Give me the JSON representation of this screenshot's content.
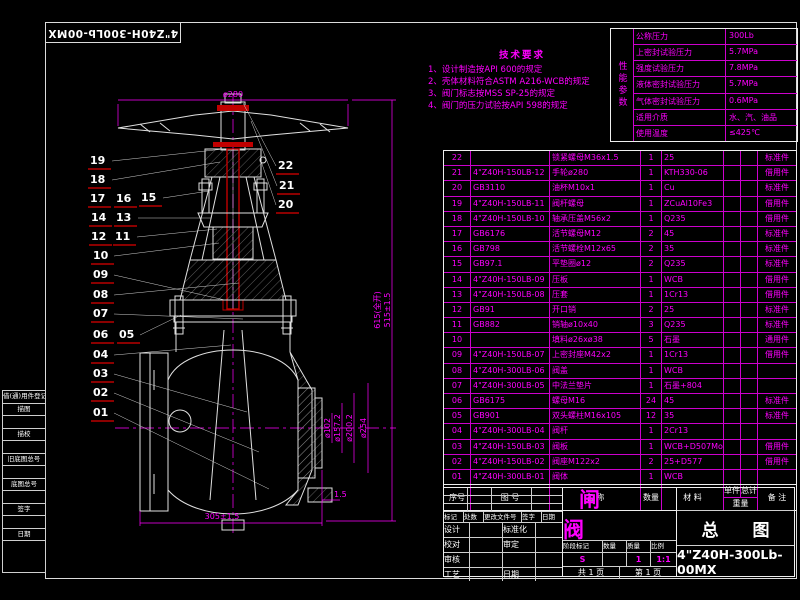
{
  "sheet": {
    "corner_stamp": "4\"Z40H-300Lb-00MX"
  },
  "tech_requirements": {
    "title": "技术要求",
    "items": [
      "1、设计制造按API 600的规定",
      "2、壳体材料符合ASTM A216-WCB的规定",
      "3、阀门标志按MSS SP-25的规定",
      "4、阀门的压力试验按API 598的规定"
    ]
  },
  "performance_table": {
    "caption": "性能参数",
    "rows": [
      {
        "label": "公称压力",
        "value": "300Lb"
      },
      {
        "label": "上密封试验压力",
        "value": "5.7MPa"
      },
      {
        "label": "强度试验压力",
        "value": "7.8MPa"
      },
      {
        "label": "液体密封试验压力",
        "value": "5.7MPa"
      },
      {
        "label": "气体密封试验压力",
        "value": "0.6MPa"
      },
      {
        "label": "适用介质",
        "value": "水、汽、油品"
      },
      {
        "label": "使用温度",
        "value": "≤425℃"
      }
    ]
  },
  "parts_table": {
    "headers": {
      "seq": "序号",
      "dwg_no": "图    号",
      "name": "名    称",
      "qty": "数量",
      "material": "材    料",
      "unit": "单件",
      "total": "总计",
      "weight": "重量",
      "remark": "备  注"
    },
    "rows": [
      {
        "seq": "22",
        "dwg_no": "",
        "name": "锁紧螺母M36x1.5",
        "qty": "1",
        "material": "25",
        "remark": "标准件"
      },
      {
        "seq": "21",
        "dwg_no": "4\"Z40H-150LB-12",
        "name": "手轮ø280",
        "qty": "1",
        "material": "KTH330-06",
        "remark": "借用件"
      },
      {
        "seq": "20",
        "dwg_no": "GB3110",
        "name": "油杯M10x1",
        "qty": "1",
        "material": "Cu",
        "remark": "标准件"
      },
      {
        "seq": "19",
        "dwg_no": "4\"Z40H-150LB-11",
        "name": "阀杆螺母",
        "qty": "1",
        "material": "ZCuAl10Fe3",
        "remark": "借用件"
      },
      {
        "seq": "18",
        "dwg_no": "4\"Z40H-150LB-10",
        "name": "轴承压盖M56x2",
        "qty": "1",
        "material": "Q235",
        "remark": "借用件"
      },
      {
        "seq": "17",
        "dwg_no": "GB6176",
        "name": "活节螺母M12",
        "qty": "2",
        "material": "45",
        "remark": "标准件"
      },
      {
        "seq": "16",
        "dwg_no": "GB798",
        "name": "活节螺栓M12x65",
        "qty": "2",
        "material": "35",
        "remark": "标准件"
      },
      {
        "seq": "15",
        "dwg_no": "GB97.1",
        "name": "平垫圈ø12",
        "qty": "2",
        "material": "Q235",
        "remark": "标准件"
      },
      {
        "seq": "14",
        "dwg_no": "4\"Z40H-150LB-09",
        "name": "压板",
        "qty": "1",
        "material": "WCB",
        "remark": "借用件"
      },
      {
        "seq": "13",
        "dwg_no": "4\"Z40H-150LB-08",
        "name": "压套",
        "qty": "1",
        "material": "1Cr13",
        "remark": "借用件"
      },
      {
        "seq": "12",
        "dwg_no": "GB91",
        "name": "开口销",
        "qty": "2",
        "material": "25",
        "remark": "标准件"
      },
      {
        "seq": "11",
        "dwg_no": "GB882",
        "name": "销轴ø10x40",
        "qty": "3",
        "material": "Q235",
        "remark": "标准件"
      },
      {
        "seq": "10",
        "dwg_no": "",
        "name": "填料ø26xø38",
        "qty": "5",
        "material": "石墨",
        "remark": "通用件"
      },
      {
        "seq": "09",
        "dwg_no": "4\"Z40H-150LB-07",
        "name": "上密封座M42x2",
        "qty": "1",
        "material": "1Cr13",
        "remark": "借用件"
      },
      {
        "seq": "08",
        "dwg_no": "4\"Z40H-300LB-06",
        "name": "阀盖",
        "qty": "1",
        "material": "WCB",
        "remark": ""
      },
      {
        "seq": "07",
        "dwg_no": "4\"Z40H-300LB-05",
        "name": "中法兰垫片",
        "qty": "1",
        "material": "石墨+804",
        "remark": ""
      },
      {
        "seq": "06",
        "dwg_no": "GB6175",
        "name": "螺母M16",
        "qty": "24",
        "material": "45",
        "remark": "标准件"
      },
      {
        "seq": "05",
        "dwg_no": "GB901",
        "name": "双头螺柱M16x105",
        "qty": "12",
        "material": "35",
        "remark": "标准件"
      },
      {
        "seq": "04",
        "dwg_no": "4\"Z40H-300LB-04",
        "name": "阀杆",
        "qty": "1",
        "material": "2Cr13",
        "remark": ""
      },
      {
        "seq": "03",
        "dwg_no": "4\"Z40H-150LB-03",
        "name": "阀板",
        "qty": "1",
        "material": "WCB+D507Mo",
        "remark": "借用件"
      },
      {
        "seq": "02",
        "dwg_no": "4\"Z40H-150LB-02",
        "name": "阀座M122x2",
        "qty": "2",
        "material": "25+D577",
        "remark": "借用件"
      },
      {
        "seq": "01",
        "dwg_no": "4\"Z40H-300LB-01",
        "name": "阀体",
        "qty": "1",
        "material": "WCB",
        "remark": ""
      }
    ]
  },
  "title_block": {
    "product_title": "闸  阀",
    "sheet_title": "总  图",
    "drawing_no": "4\"Z40H-300Lb-00MX",
    "rev_header": [
      "标记",
      "处数",
      "更改文件号",
      "签字",
      "日期"
    ],
    "roles": [
      {
        "left": "设计",
        "right": "标准化"
      },
      {
        "left": "校对",
        "right": "审定"
      },
      {
        "left": "审核",
        "right": ""
      },
      {
        "left": "工艺",
        "right": "日期"
      }
    ],
    "stage_header": [
      "阶段标记",
      "数量",
      "质量",
      "比例"
    ],
    "stage_values": [
      "S",
      "",
      "1",
      "1:1"
    ],
    "pages_total": "共 1 页",
    "pages_current": "第 1 页"
  },
  "margin_strip": {
    "rows": [
      "借(通)用件登记",
      "描图",
      "",
      "描校",
      "",
      "旧底图总号",
      "",
      "底图总号",
      "",
      "签字",
      "",
      "日期"
    ]
  },
  "dimensions": {
    "handwheel_dia": "ø280",
    "face_to_face": "305±1.5",
    "raised_face": "1.5",
    "flange": [
      "ø102",
      "ø157.2",
      "ø200.2",
      "ø254"
    ],
    "height_closed": "515±1.5",
    "height_open": "615(全开)"
  },
  "balloons": [
    {
      "n": "19",
      "x": 88,
      "y": 155
    },
    {
      "n": "18",
      "x": 88,
      "y": 174
    },
    {
      "n": "17",
      "x": 88,
      "y": 193
    },
    {
      "n": "16",
      "x": 114,
      "y": 193
    },
    {
      "n": "15",
      "x": 139,
      "y": 192
    },
    {
      "n": "14",
      "x": 89,
      "y": 212
    },
    {
      "n": "13",
      "x": 114,
      "y": 212
    },
    {
      "n": "12",
      "x": 89,
      "y": 231
    },
    {
      "n": "11",
      "x": 113,
      "y": 231
    },
    {
      "n": "10",
      "x": 91,
      "y": 250
    },
    {
      "n": "09",
      "x": 91,
      "y": 269
    },
    {
      "n": "08",
      "x": 91,
      "y": 289
    },
    {
      "n": "07",
      "x": 91,
      "y": 308
    },
    {
      "n": "06",
      "x": 91,
      "y": 329
    },
    {
      "n": "05",
      "x": 117,
      "y": 329
    },
    {
      "n": "04",
      "x": 91,
      "y": 349
    },
    {
      "n": "03",
      "x": 91,
      "y": 368
    },
    {
      "n": "02",
      "x": 91,
      "y": 387
    },
    {
      "n": "01",
      "x": 91,
      "y": 407
    },
    {
      "n": "22",
      "x": 276,
      "y": 160
    },
    {
      "n": "21",
      "x": 277,
      "y": 180
    },
    {
      "n": "20",
      "x": 276,
      "y": 199
    }
  ],
  "colors": {
    "line": "#ff00ff",
    "draw": "#e0e0e0",
    "accent_red": "#c00000",
    "underline": "#8b0000"
  }
}
